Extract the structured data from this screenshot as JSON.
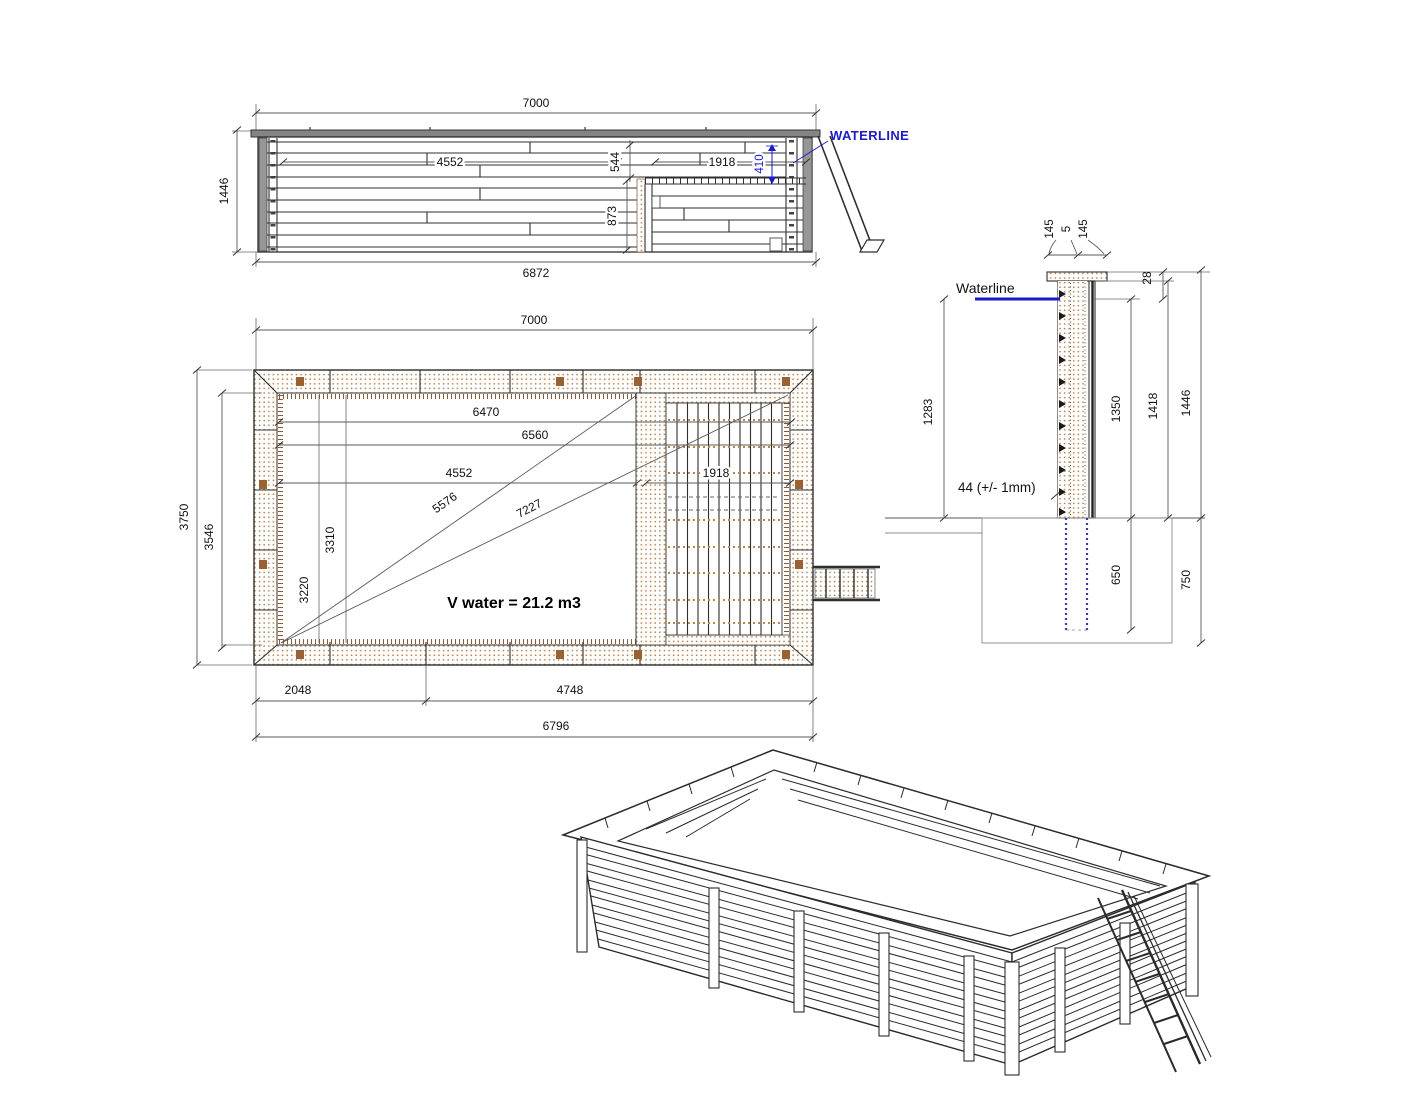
{
  "drawing": {
    "elevation": {
      "dim_width_top": "7000",
      "dim_height": "1446",
      "dim_inner_left": "4552",
      "dim_gap": "544",
      "dim_platform_width": "1918",
      "dim_waterline_offset": "410",
      "dim_platform_height": "873",
      "dim_width_bottom": "6872",
      "waterline_label": "WATERLINE"
    },
    "plan": {
      "dim_width_top": "7000",
      "dim_height_outer": "3750",
      "dim_height_inner": "3546",
      "dim_6470": "6470",
      "dim_6560": "6560",
      "dim_4552": "4552",
      "dim_diag_short": "5576",
      "dim_diag_long": "7227",
      "dim_deck_width": "1918",
      "dim_3310": "3310",
      "dim_3220": "3220",
      "dim_2048": "2048",
      "dim_4748": "4748",
      "dim_width_bottom": "6796",
      "volume_label": "V water = 21.2 m3"
    },
    "section": {
      "dim_cap_left": "145",
      "dim_cap_center": "5",
      "dim_cap_right": "145",
      "dim_28": "28",
      "waterline_label": "Waterline",
      "dim_1283": "1283",
      "dim_1350": "1350",
      "dim_1418": "1418",
      "dim_1446": "1446",
      "tolerance_label": "44 (+/- 1mm)",
      "dim_650": "650",
      "dim_750": "750"
    },
    "colors": {
      "accent_blue": "#1b1bc8",
      "wood_dot": "#b9854e",
      "wood_dark": "#9a6233",
      "line_dark": "#2f2f2f",
      "dim_gray": "#5a5a5a",
      "cap_gray": "#8a8a8a"
    }
  }
}
